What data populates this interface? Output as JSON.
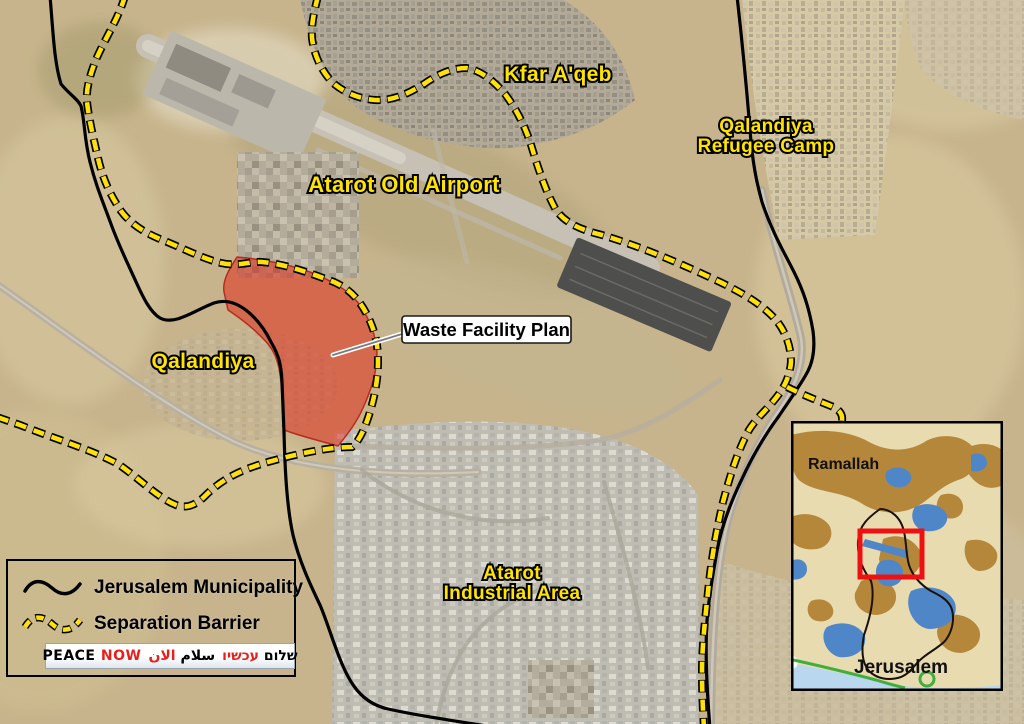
{
  "map": {
    "labels": {
      "kfar_aqeb": "Kfar A'qeb",
      "refugee_camp_line1": "Qalandiya",
      "refugee_camp_line2": "Refugee Camp",
      "airport": "Atarot Old Airport",
      "qalandiya": "Qalandiya",
      "industrial_line1": "Atarot",
      "industrial_line2": "Industrial Area",
      "waste_facility": "Waste Facility Plan"
    },
    "label_color": "#ffe400"
  },
  "legend": {
    "items": [
      {
        "label": "Jerusalem Municipality",
        "symbol": "black-line"
      },
      {
        "label": "Separation Barrier",
        "symbol": "yellow-dashed-line"
      }
    ]
  },
  "logo": {
    "english": [
      "PEACE",
      "NOW"
    ],
    "arabic": [
      "سلام",
      "الان"
    ],
    "hebrew": [
      "שלום",
      "עכשיו"
    ],
    "accent_red": "#e8201d"
  },
  "inset": {
    "labels": {
      "ramallah": "Ramallah",
      "jerusalem": "Jerusalem"
    },
    "colors": {
      "background": "#e9dbb0",
      "built_up_brown": "#b5873b",
      "built_up_blue": "#4f86c8",
      "water_band": "#b9d7ee",
      "highlight_box": "#ee1111",
      "green_line": "#3fae3c"
    }
  },
  "colors": {
    "barrier_yellow": "#ffe10a",
    "municipality_black": "#000000",
    "waste_area_red": "#df2b1c"
  }
}
